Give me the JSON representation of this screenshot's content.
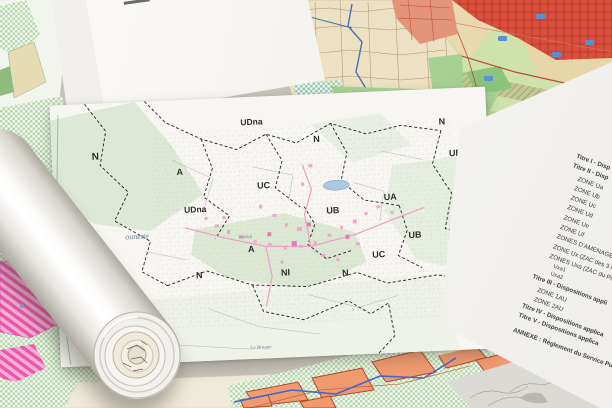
{
  "cover_page": {
    "title_line1": "Plan Local",
    "title_line2": "d'Urbanisme",
    "subtitle1": "MODIFICATION - DOSSIER D'APPROBATION",
    "subtitle2": "Planche générale"
  },
  "cover_page_under": {
    "edge_title": "n Local d'Urbanisme",
    "edge_subtitle": "Modification"
  },
  "zoning_map": {
    "zone_labels": [
      "N",
      "UDna",
      "A",
      "UC",
      "UDna",
      "N",
      "N",
      "UB",
      "UA",
      "UB",
      "A",
      "UB",
      "UC",
      "A",
      "N",
      "NI",
      "N"
    ],
    "place_names": [
      "ounette",
      "Rivière",
      "La Braque"
    ]
  },
  "toc_page": {
    "lines": [
      "Titre I - Disp",
      "Titre II - Disp",
      "ZONE Ua",
      "ZONE Ub",
      "ZONE Uc",
      "ZONE Ud",
      "ZONE Ue",
      "ZONE Uf",
      "ZONES D'AMENAGEMENT",
      "ZONE Ux (ZAC des 3 R",
      "ZONES Uxa (ZAC du Pu",
      "Uxa1",
      "Uxa2",
      "Titre III - Dispositions appli",
      "ZONE 1AU",
      "ZONE 2AU",
      "Titre IV - Dispositions applica",
      "Titre V - Dispositions applica",
      "ANNEXE : Règlement du Service Publ"
    ]
  },
  "colors": {
    "urban_red": "#d94f3c",
    "zone_light_green": "#cfe2ab",
    "checker_green": "#b7d9ac",
    "magenta_zone": "#e958a8",
    "orange_parcel": "#f09a70",
    "pond_blue": "#aac8e2",
    "building_pink": "#f0a6ce",
    "cadastre_beige": "#ece1c2"
  }
}
